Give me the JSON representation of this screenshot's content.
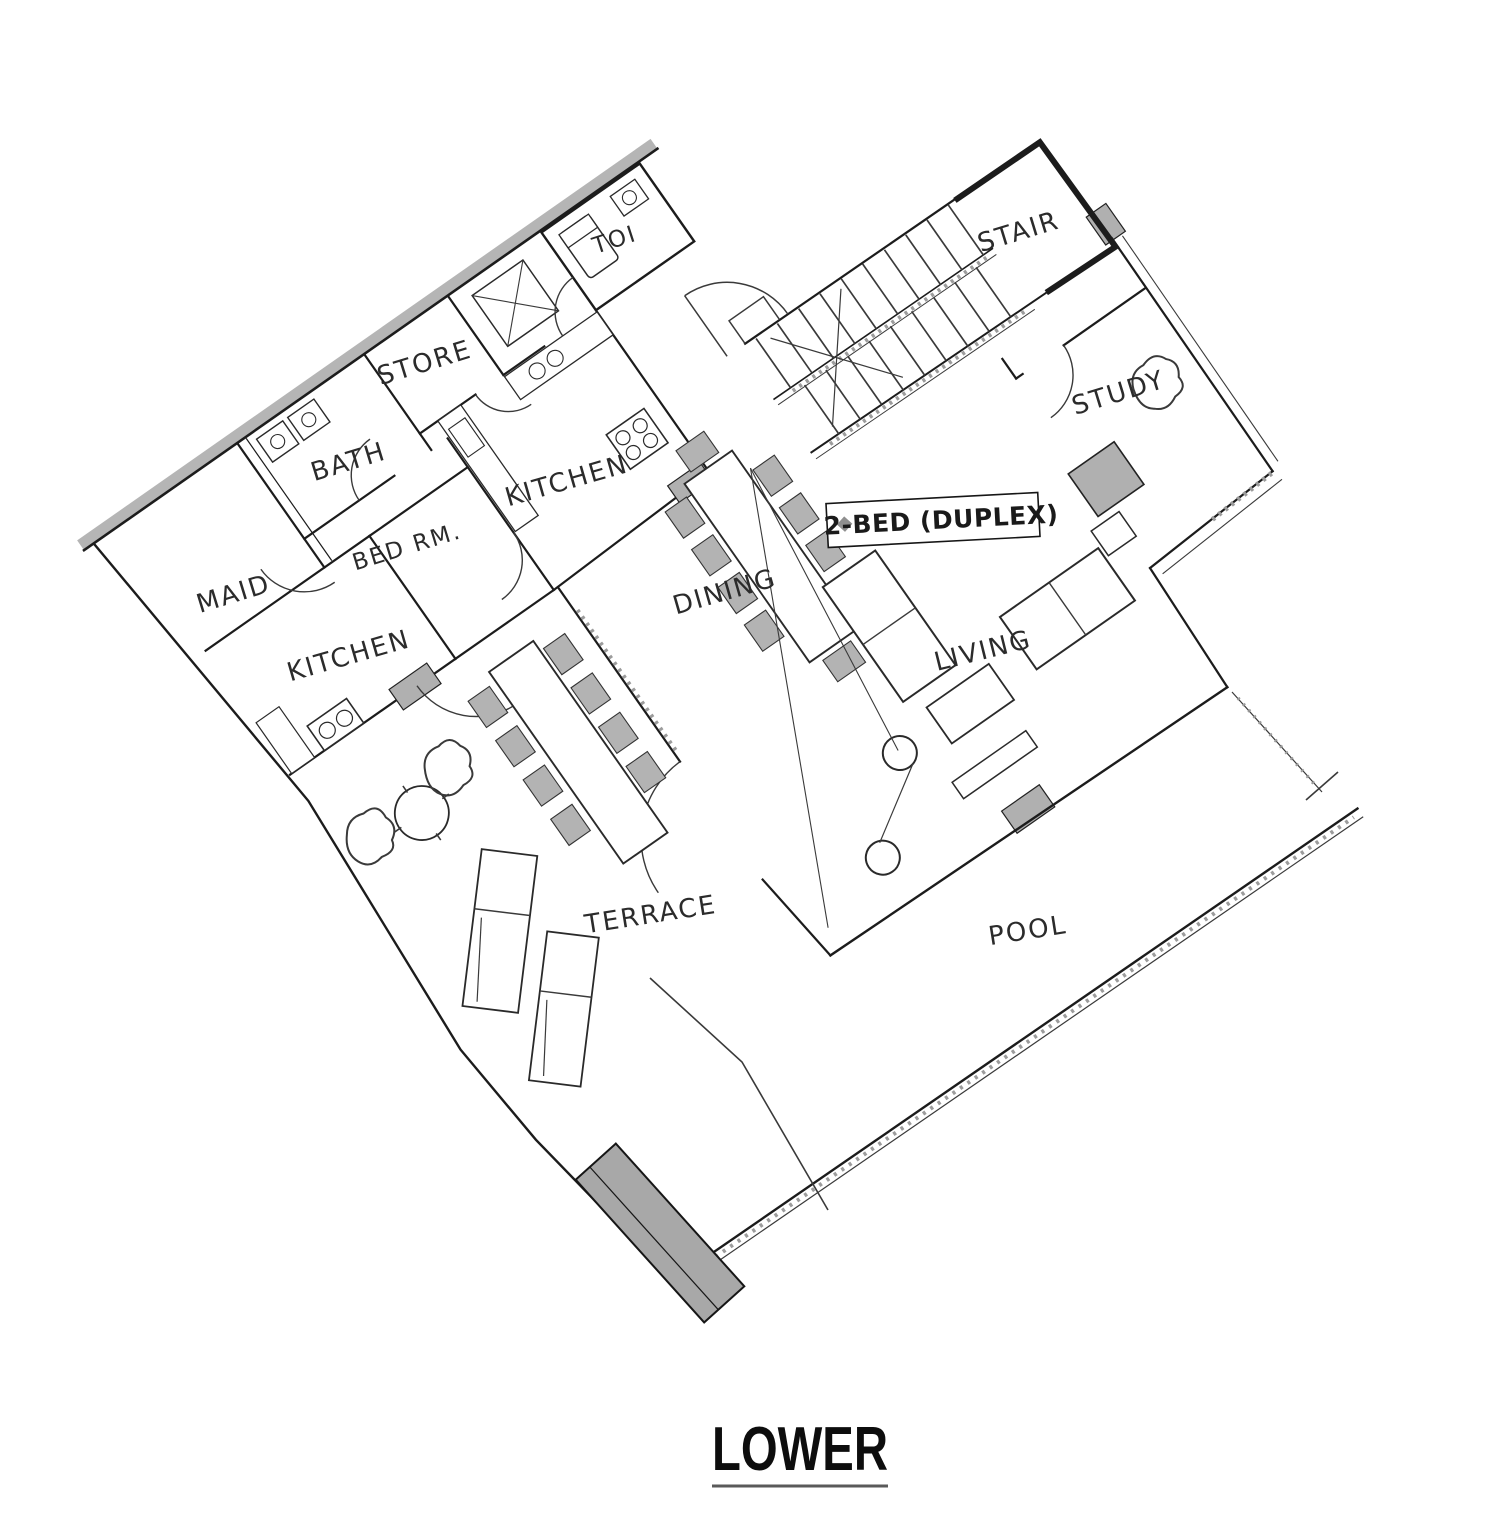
{
  "title": {
    "label": "LOWER"
  },
  "unit_tag": {
    "label": "2-BED (DUPLEX)"
  },
  "room_labels": {
    "toi": "TOI",
    "store": "STORE",
    "bath": "BATH",
    "kitchen_main": "KITCHEN",
    "bed_rm": "BED RM.",
    "maid": "MAID",
    "kitchen_maid": "KITCHEN",
    "dining": "DINING",
    "living": "LIVING",
    "study": "STUDY",
    "stair": "STAIR",
    "terrace": "TERRACE",
    "pool": "POOL"
  },
  "colors": {
    "wall": "#1c1c1c",
    "shaded_fill": "#b0b0b0",
    "hatch_gray": "#9c9c9c",
    "paper": "#ffffff",
    "label_ink": "#2b2b2b"
  }
}
